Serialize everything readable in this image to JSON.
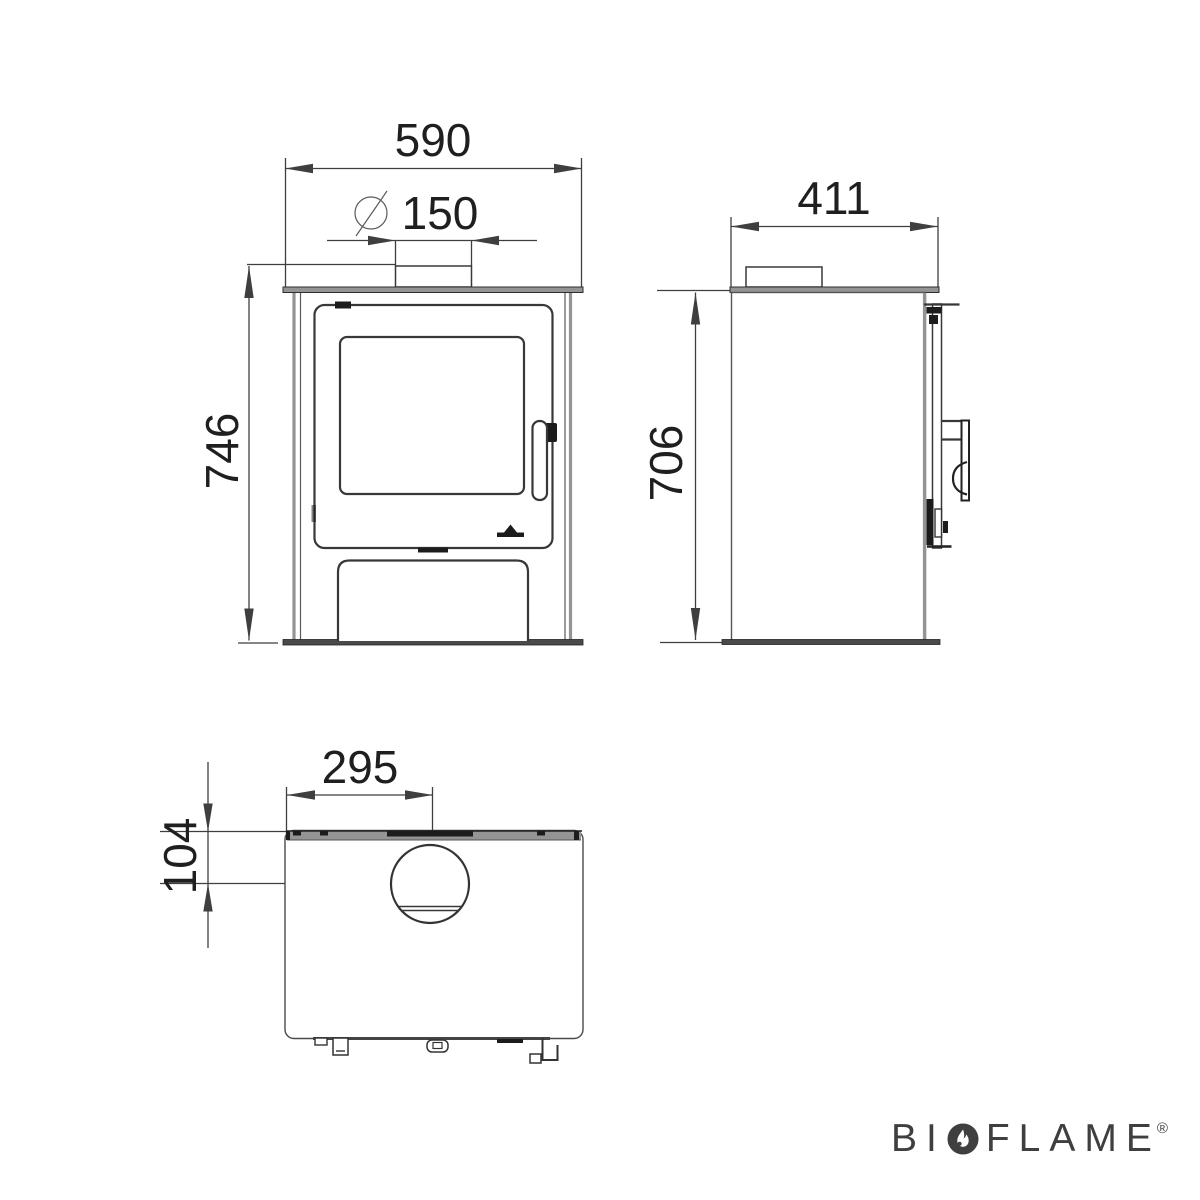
{
  "front_view": {
    "width_label": "590",
    "flue": {
      "symbol": "⌀",
      "value": "150"
    },
    "height_label": "746"
  },
  "side_view": {
    "depth_label": "411",
    "height_label": "706"
  },
  "top_view": {
    "flue_offset_from_side_label": "295",
    "flue_offset_from_back_label": "104"
  },
  "brand": {
    "left": "BI",
    "right": "FLAME",
    "registered": "®",
    "flame_icon": "flame-in-circle-icon"
  },
  "colors": {
    "background": "#ffffff",
    "line": "#3f3f3f",
    "edge": "#383838",
    "dark": "#1c1c1c",
    "plate": "#949494",
    "text": "#1f1f1f",
    "brand": "#3f3f3f"
  }
}
